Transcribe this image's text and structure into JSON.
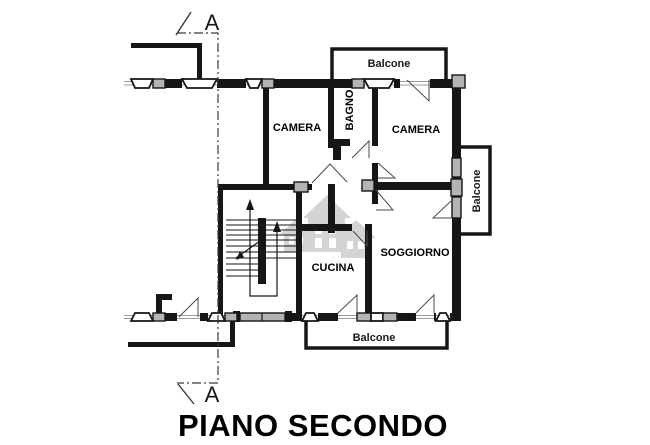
{
  "title": "PIANO SECONDO",
  "section": {
    "label_top": "A",
    "label_bottom": "A"
  },
  "rooms": {
    "camera_left": "CAMERA",
    "bagno": "BAGNO",
    "camera_right": "CAMERA",
    "soggiorno": "SOGGIORNO",
    "cucina": "CUCINA"
  },
  "balconies": {
    "top": "Balcone",
    "right": "Balcone",
    "bottom": "Balcone"
  },
  "colors": {
    "wall": "#161616",
    "sash": "#b4b4b4",
    "sill": "#9c9c9c",
    "swing": "#4a4a4a",
    "watermark": "#b2b2b2",
    "background": "#ffffff"
  }
}
